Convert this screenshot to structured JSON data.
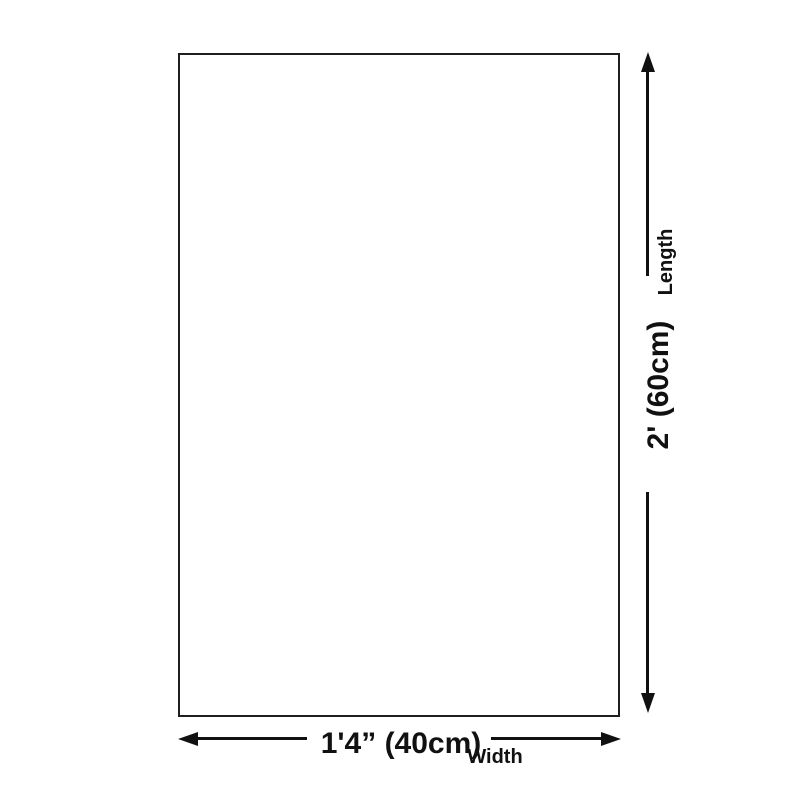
{
  "page": {
    "background": "#ffffff"
  },
  "diagram": {
    "shape": "rectangle",
    "line_color": "#111111",
    "vertical_dimension": {
      "value": "2' (60cm)",
      "axis_label": "Length"
    },
    "horizontal_dimension": {
      "value": "1'4” (40cm)",
      "axis_label": "Width"
    }
  }
}
